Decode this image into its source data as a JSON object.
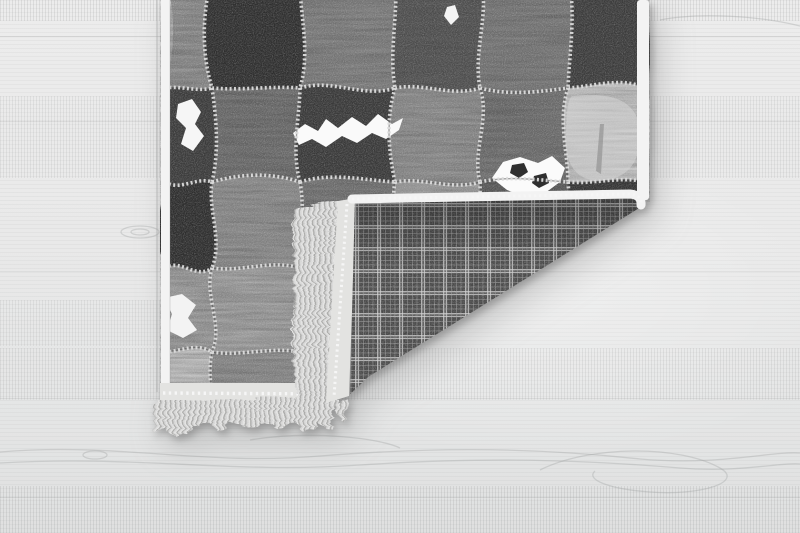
{
  "meta": {
    "description": "Product photo: grayscale patchwork leather rug lying on a light gray wooden floor, bottom-right corner folded over revealing a dark gray plaid woven backing, a white binding strip and pale fringe tassels along the folded edge and along the rug bottom edge."
  },
  "floor": {
    "base_color": "#e9eaea",
    "grain_color": "#9a9c9c",
    "seam_color": "#b4b6b6"
  },
  "rug": {
    "grid": {
      "cols": [
        165,
        212,
        300,
        395,
        480,
        568,
        646
      ],
      "rows": [
        -25,
        88,
        182,
        268,
        352,
        434
      ]
    },
    "patch_rows": [
      [
        "#8e8e8e",
        "#2e2e2e",
        "#808080",
        "#525252",
        "#7a7a7a",
        "#3d3d3d"
      ],
      [
        "#3c3c3c",
        "#6e6e6e",
        "#3a3a3a",
        "#8f8f8f",
        "#717171",
        "#c7c7c7"
      ],
      [
        "#2d2d2d",
        "#909090",
        "#757575",
        "#a0a0a0",
        "#5a5a5a",
        "#343434"
      ],
      [
        "#9e9e9e",
        "#a2a2a2",
        "#424242",
        "#8c8c8c",
        "#6c6c6c",
        "#7a7a7a"
      ],
      [
        "#c2c2c2",
        "#8e8e8e",
        "#707070",
        "#9a9a9a",
        "#585858",
        "#8a8a8a"
      ]
    ],
    "stitch": {
      "light": "#dcdcdc",
      "dark": "#4a4a4a"
    },
    "border_color": "#f3f3f3",
    "binding_color": "#e3e3e1",
    "fringe": {
      "light": "#e4e4e3",
      "mid": "#cccccb",
      "dark": "#a6a6a5"
    },
    "plaid": {
      "base": "#4a4a4a",
      "line_bright": "#cfcfcf",
      "line_faint": "#9f9f9f"
    },
    "accents": [
      {
        "name": "white-fur-streak",
        "fill": "#fafafa",
        "opacity": 1,
        "path": "M293,133 L305,124 L318,131 L326,119 L338,128 L352,117 L366,126 L378,114 L392,124 L403,118 L399,130 L386,139 L372,133 L357,143 L342,136 L326,147 L312,139 L299,145 Z"
      },
      {
        "name": "white-blotch-left",
        "fill": "#f6f6f6",
        "opacity": 1,
        "path": "M178,104 L192,99 L201,112 L195,124 L204,136 L193,151 L181,144 L186,128 L176,118 Z"
      },
      {
        "name": "cowhide-spot-patch",
        "fill": "#fbfbfb",
        "opacity": 1,
        "path": "M492,178 L503,162 L520,157 L538,163 L552,156 L565,168 L560,182 L545,193 L525,197 L507,190 Z"
      },
      {
        "name": "cowhide-dark-spot",
        "fill": "#2f2f2f",
        "opacity": 1,
        "path": "M512,165 L524,163 L528,172 L519,178 L510,173 Z"
      },
      {
        "name": "cowhide-dark-spot",
        "fill": "#2f2f2f",
        "opacity": 1,
        "path": "M534,176 L546,173 L549,183 L539,188 L532,183 Z"
      },
      {
        "name": "white-spot-top",
        "fill": "#f4f4f4",
        "opacity": 1,
        "path": "M447,7 L455,5 L459,17 L451,25 L444,16 Z"
      },
      {
        "name": "white-blotch-lower-left",
        "fill": "#f3f3f3",
        "opacity": 1,
        "path": "M164,298 L182,294 L196,305 L188,318 L197,330 L183,338 L167,330 L172,314 Z"
      },
      {
        "name": "silver-fur-sheen",
        "fill": "#d6d6d6",
        "opacity": 0.55,
        "path": "M572,96 Q640,88 640,135 Q640,180 597,181 Q566,178 566,140 Q566,100 572,96 Z"
      },
      {
        "name": "silver-fur-crease",
        "fill": "#8a8a8a",
        "opacity": 0.6,
        "path": "M600,124 L604,124 L601,174 L596,171 Z"
      }
    ]
  }
}
